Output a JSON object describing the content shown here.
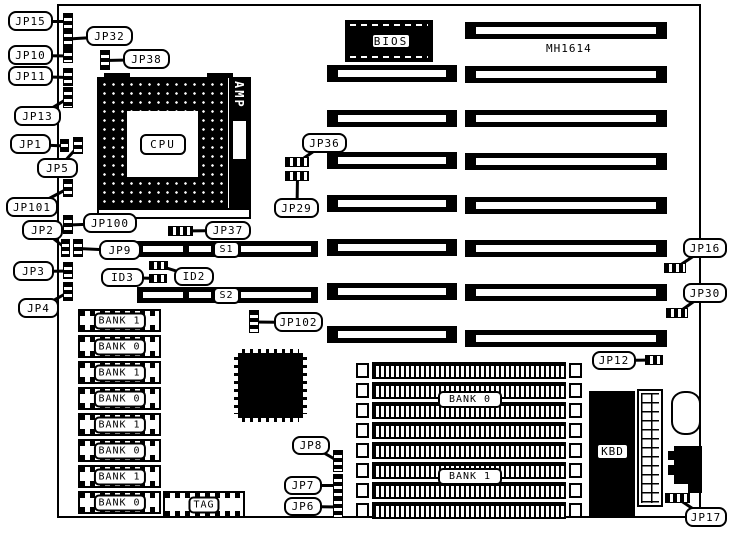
{
  "colors": {
    "ink": "#000000",
    "paper": "#ffffff"
  },
  "board": {
    "model": "MH1614"
  },
  "chips": {
    "cpu": "CPU",
    "amp": "AMP",
    "bios": "BIOS",
    "kbd": "KBD",
    "tag": "TAG"
  },
  "slots": {
    "s1": "S1",
    "s2": "S2"
  },
  "memory": {
    "left_bank_labels": [
      "BANK 1",
      "BANK 0",
      "BANK 1",
      "BANK 0",
      "BANK 1",
      "BANK 0",
      "BANK 1",
      "BANK 0"
    ],
    "right_bank_top": "BANK 0",
    "right_bank_bottom": "BANK 1"
  },
  "callouts": [
    {
      "id": "JP15",
      "label": "JP15",
      "box": [
        8,
        11,
        45,
        20
      ],
      "jumper": [
        63,
        13,
        10,
        16
      ],
      "jtype": "v"
    },
    {
      "id": "JP32",
      "label": "JP32",
      "box": [
        86,
        26,
        47,
        20
      ],
      "jumper": [
        63,
        29,
        10,
        19
      ],
      "jtype": "v"
    },
    {
      "id": "JP10",
      "label": "JP10",
      "box": [
        8,
        45,
        45,
        20
      ],
      "jumper": [
        63,
        48,
        10,
        15
      ],
      "jtype": "v"
    },
    {
      "id": "JP38",
      "label": "JP38",
      "box": [
        123,
        49,
        47,
        20
      ],
      "jumper": [
        100,
        50,
        10,
        20
      ],
      "jtype": "v"
    },
    {
      "id": "JP11",
      "label": "JP11",
      "box": [
        8,
        66,
        45,
        20
      ],
      "jumper": [
        63,
        68,
        10,
        18
      ],
      "jtype": "v"
    },
    {
      "id": "JP13",
      "label": "JP13",
      "box": [
        14,
        106,
        47,
        20
      ],
      "jumper": [
        63,
        87,
        10,
        21
      ],
      "jtype": "v"
    },
    {
      "id": "JP1",
      "label": "JP1",
      "box": [
        10,
        134,
        41,
        20
      ],
      "jumper": [
        60,
        139,
        9,
        13
      ],
      "jtype": "v"
    },
    {
      "id": "JP5",
      "label": "JP5",
      "box": [
        37,
        158,
        41,
        20
      ],
      "jumper": [
        73,
        137,
        10,
        17
      ],
      "jtype": "v"
    },
    {
      "id": "JP101",
      "label": "JP101",
      "box": [
        6,
        197,
        52,
        20
      ],
      "jumper": [
        63,
        179,
        10,
        18
      ],
      "jtype": "v"
    },
    {
      "id": "JP100",
      "label": "JP100",
      "box": [
        83,
        213,
        54,
        20
      ],
      "jumper": [
        63,
        215,
        10,
        19
      ],
      "jtype": "v"
    },
    {
      "id": "JP2",
      "label": "JP2",
      "box": [
        22,
        220,
        41,
        20
      ],
      "jumper": [
        61,
        239,
        9,
        18
      ],
      "jtype": "v"
    },
    {
      "id": "JP9",
      "label": "JP9",
      "box": [
        99,
        240,
        42,
        20
      ],
      "jumper": [
        73,
        239,
        10,
        18
      ],
      "jtype": "v"
    },
    {
      "id": "JP37",
      "label": "JP37",
      "box": [
        205,
        221,
        46,
        19
      ],
      "jumper": [
        168,
        226,
        25,
        10
      ],
      "jtype": "h"
    },
    {
      "id": "JP3",
      "label": "JP3",
      "box": [
        13,
        261,
        41,
        20
      ],
      "jumper": [
        63,
        262,
        10,
        17
      ],
      "jtype": "v"
    },
    {
      "id": "ID3",
      "label": "ID3",
      "box": [
        101,
        268,
        43,
        19
      ],
      "jumper": [
        149,
        274,
        18,
        9
      ],
      "jtype": "h"
    },
    {
      "id": "ID2",
      "label": "ID2",
      "box": [
        174,
        267,
        40,
        19
      ],
      "jumper": [
        149,
        261,
        19,
        9
      ],
      "jtype": "h"
    },
    {
      "id": "JP4",
      "label": "JP4",
      "box": [
        18,
        298,
        41,
        20
      ],
      "jumper": [
        63,
        282,
        10,
        19
      ],
      "jtype": "v"
    },
    {
      "id": "JP36",
      "label": "JP36",
      "box": [
        302,
        133,
        45,
        20
      ],
      "jumper": [
        285,
        157,
        24,
        10
      ],
      "jtype": "h"
    },
    {
      "id": "JP29",
      "label": "JP29",
      "box": [
        274,
        198,
        45,
        20
      ],
      "jumper": [
        285,
        171,
        24,
        10
      ],
      "jtype": "h"
    },
    {
      "id": "JP102",
      "label": "JP102",
      "box": [
        274,
        312,
        49,
        20
      ],
      "jumper": [
        249,
        310,
        10,
        23
      ],
      "jtype": "v"
    },
    {
      "id": "JP16",
      "label": "JP16",
      "box": [
        683,
        238,
        44,
        20
      ],
      "jumper": [
        664,
        263,
        22,
        10
      ],
      "jtype": "h"
    },
    {
      "id": "JP30",
      "label": "JP30",
      "box": [
        683,
        283,
        44,
        20
      ],
      "jumper": [
        666,
        308,
        22,
        10
      ],
      "jtype": "h"
    },
    {
      "id": "JP12",
      "label": "JP12",
      "box": [
        592,
        351,
        44,
        19
      ],
      "jumper": [
        645,
        355,
        18,
        10
      ],
      "jtype": "h"
    },
    {
      "id": "JP8",
      "label": "JP8",
      "box": [
        292,
        436,
        38,
        19
      ],
      "jumper": [
        333,
        450,
        10,
        22
      ],
      "jtype": "v"
    },
    {
      "id": "JP7",
      "label": "JP7",
      "box": [
        284,
        476,
        38,
        19
      ],
      "jumper": [
        333,
        474,
        10,
        23
      ],
      "jtype": "v"
    },
    {
      "id": "JP6",
      "label": "JP6",
      "box": [
        284,
        497,
        38,
        19
      ],
      "jumper": [
        333,
        496,
        10,
        22
      ],
      "jtype": "v"
    },
    {
      "id": "JP17",
      "label": "JP17",
      "box": [
        685,
        507,
        42,
        20
      ],
      "jumper": [
        665,
        493,
        25,
        10
      ],
      "jtype": "h"
    }
  ],
  "geometry": {
    "right_isa_slots": {
      "x": 465,
      "w": 202,
      "h": 17,
      "y": [
        22,
        66,
        110,
        153,
        197,
        240,
        284,
        330
      ]
    },
    "middle_isa_slots": {
      "x": 327,
      "w": 130,
      "h": 17,
      "y": [
        65,
        110,
        152,
        195,
        239,
        283,
        326
      ]
    },
    "s_bars": {
      "x": 137,
      "w": 181,
      "h": 16,
      "rows": [
        {
          "y": 241,
          "key": "s1"
        },
        {
          "y": 287,
          "key": "s2"
        }
      ],
      "segs": [
        [
          6,
          40
        ],
        [
          52,
          22
        ],
        [
          104,
          70
        ]
      ],
      "label_off": 76,
      "label_w": 27
    },
    "left_simm": {
      "x": 78,
      "w": 83,
      "h": 23,
      "y": [
        309,
        335,
        361,
        387,
        413,
        439,
        465,
        491
      ]
    },
    "right_simm": {
      "x": 356,
      "w": 226,
      "h": 17,
      "y": [
        362,
        382,
        402,
        422,
        442,
        462,
        482,
        502
      ]
    },
    "right_bank_labels": {
      "top": [
        438,
        391,
        64,
        17
      ],
      "bottom": [
        438,
        468,
        64,
        17
      ]
    }
  }
}
